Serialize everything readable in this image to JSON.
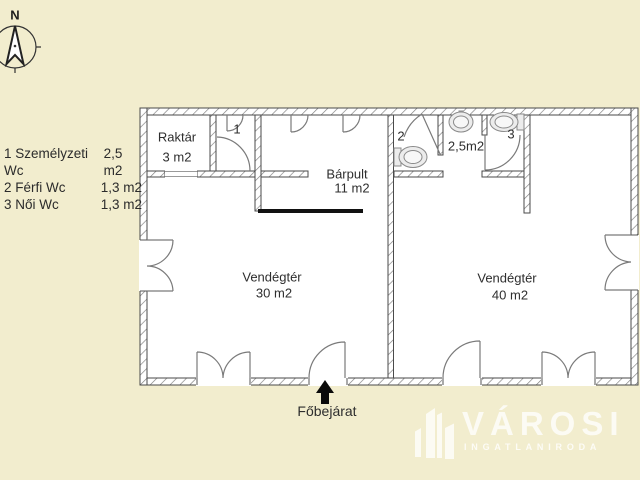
{
  "compass": {
    "label": "N"
  },
  "legend": {
    "items": [
      {
        "label": "1 Személyzeti Wc",
        "area": "2,5 m2"
      },
      {
        "label": "2 Férfi Wc",
        "area": "1,3 m2"
      },
      {
        "label": "3 Női Wc",
        "area": "1,3 m2"
      }
    ]
  },
  "rooms": {
    "raktar": {
      "name": "Raktár",
      "area": "3 m2"
    },
    "barpult": {
      "name": "Bárpult",
      "area": "11 m2"
    },
    "vendegter30": {
      "name": "Vendégtér",
      "area": "30 m2"
    },
    "vendegter40": {
      "name": "Vendégtér",
      "area": "40 m2"
    },
    "wc1_number": "1",
    "wc2_number": "2",
    "wc3_number": "3",
    "vestibule_area": "2,5m2"
  },
  "entrance": {
    "label": "Főbejárat"
  },
  "watermark": {
    "title": "VÁROSI",
    "subtitle": "INGATLANIRODA"
  },
  "colors": {
    "background": "#f2edce",
    "floor": "#ffffff",
    "wall_line": "#4a4a4a",
    "door_arc": "#777777",
    "counter": "#111111",
    "text": "#2e2e2e",
    "watermark": "rgba(255,255,255,0.8)"
  }
}
